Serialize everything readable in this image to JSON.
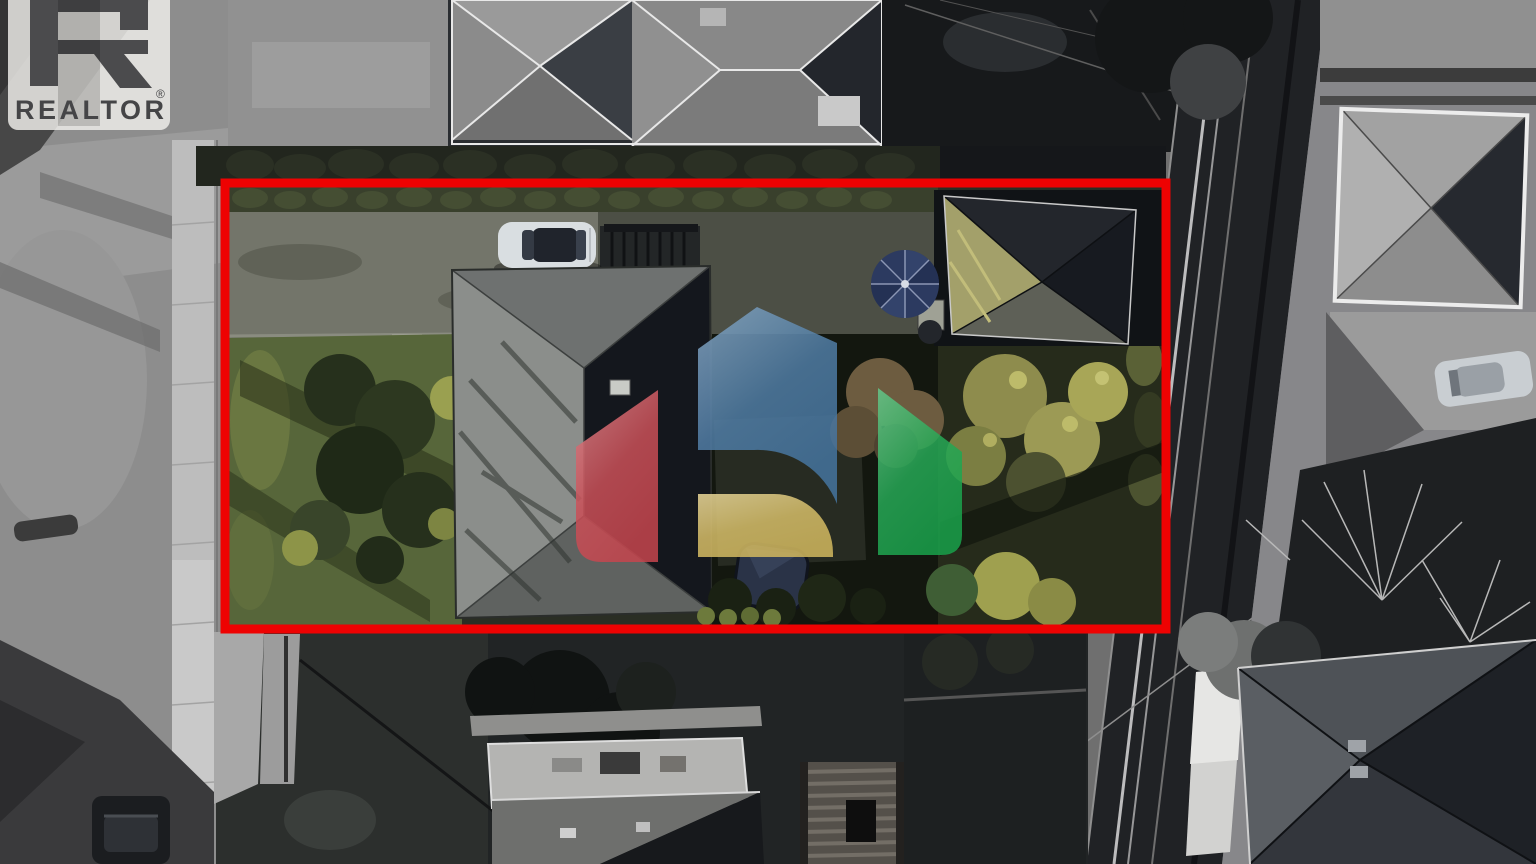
{
  "watermarks": {
    "realtor": {
      "wordmark": "REALTOR",
      "registered": "®"
    },
    "brand_logo_colors": {
      "red": "#c6454e",
      "blue": "#45749f",
      "yellow": "#d2b95e",
      "green": "#1aa24b"
    }
  },
  "annotation": {
    "boundary_color": "#ee0202"
  },
  "scene_colors": {
    "white_car": "#d9dee1",
    "dark_car": "#1b1d20",
    "gray_car": "#c9ced2",
    "patio_umbrella": "#2c3a60",
    "hot_tub_cover": "#2a3347"
  }
}
